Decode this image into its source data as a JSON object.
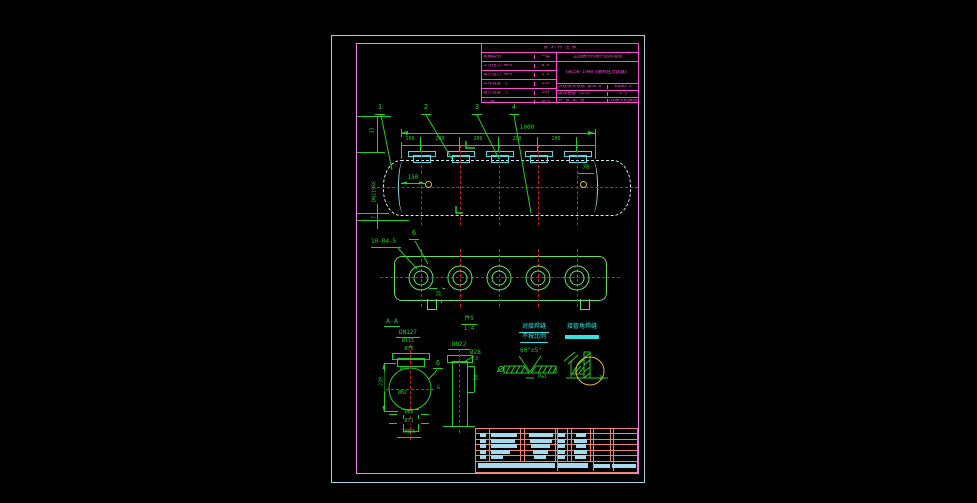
{
  "title_block": {
    "header": "技 术 特 性 表",
    "left_rows": [
      {
        "label": "容器类别",
        "value": "一类"
      },
      {
        "label": "工作压力 MPa",
        "value": "0.4"
      },
      {
        "label": "设计压力 MPa",
        "value": "1.2"
      },
      {
        "label": "工作温度 ℃",
        "value": "151"
      },
      {
        "label": "设计温度 ℃",
        "value": "191"
      },
      {
        "label": "介 质",
        "value": "蒸汽"
      }
    ],
    "right_header": "全国通用机械产品标准图",
    "standard": "GB150-1998《钢制压力容器》",
    "bottom_rows": [
      {
        "label": "焊接接头系数 φ=0.8",
        "value": "DQG6-5"
      },
      {
        "label": "腐蚀裕量 C2=1",
        "value": "1:4"
      },
      {
        "label": "共 张 第 张",
        "value": "A3通用机械图"
      }
    ]
  },
  "top_view": {
    "balloons": [
      "1",
      "2",
      "3",
      "4"
    ],
    "overall_dim": "1000",
    "chain_dims": [
      "100",
      "200",
      "200",
      "200",
      "200"
    ],
    "left_dims": {
      "top": "33",
      "pipe": "DN219X6",
      "bottom": "7"
    },
    "dim_150": "150",
    "dim_70": "70"
  },
  "middle_view": {
    "radius_label": "10-R4.5",
    "balloon": "6",
    "tab_dim": "35"
  },
  "details": {
    "aa": {
      "title": "A-A",
      "flange_label": "DN127",
      "d1": "Ø115",
      "d2": "Ø75",
      "inner_d1": "Ø75",
      "inner_d2": "Ø62",
      "height": "239",
      "balloon": "6",
      "side_mark": "G",
      "b1": "Ø68",
      "b2": "Ø71",
      "b3": "DN83"
    },
    "part5": {
      "title": "件5",
      "scale": "1:4",
      "label": "DN22",
      "d1": "Ø28",
      "d2": "3",
      "d3": "50"
    },
    "butt_weld": {
      "title": "对接焊缝",
      "subtitle": "不按比例",
      "angle": "60°±5°",
      "gap": "P±1"
    },
    "fillet_weld": {
      "title": "接管角焊缝",
      "mark": "3"
    }
  },
  "colors": {
    "dimension": "#24cd24",
    "centerline": "#d61f1f",
    "flange": "#55d8e4",
    "shell": "#cfeef0",
    "frame_outer": "#a9cfe0",
    "frame_inner": "#ee86ea",
    "title_text": "#ff49d3",
    "table_grid": "#ef8272",
    "table_fill": "#a6d9ec",
    "marker": "#dcba35",
    "weld_note": "#33e3e3"
  }
}
